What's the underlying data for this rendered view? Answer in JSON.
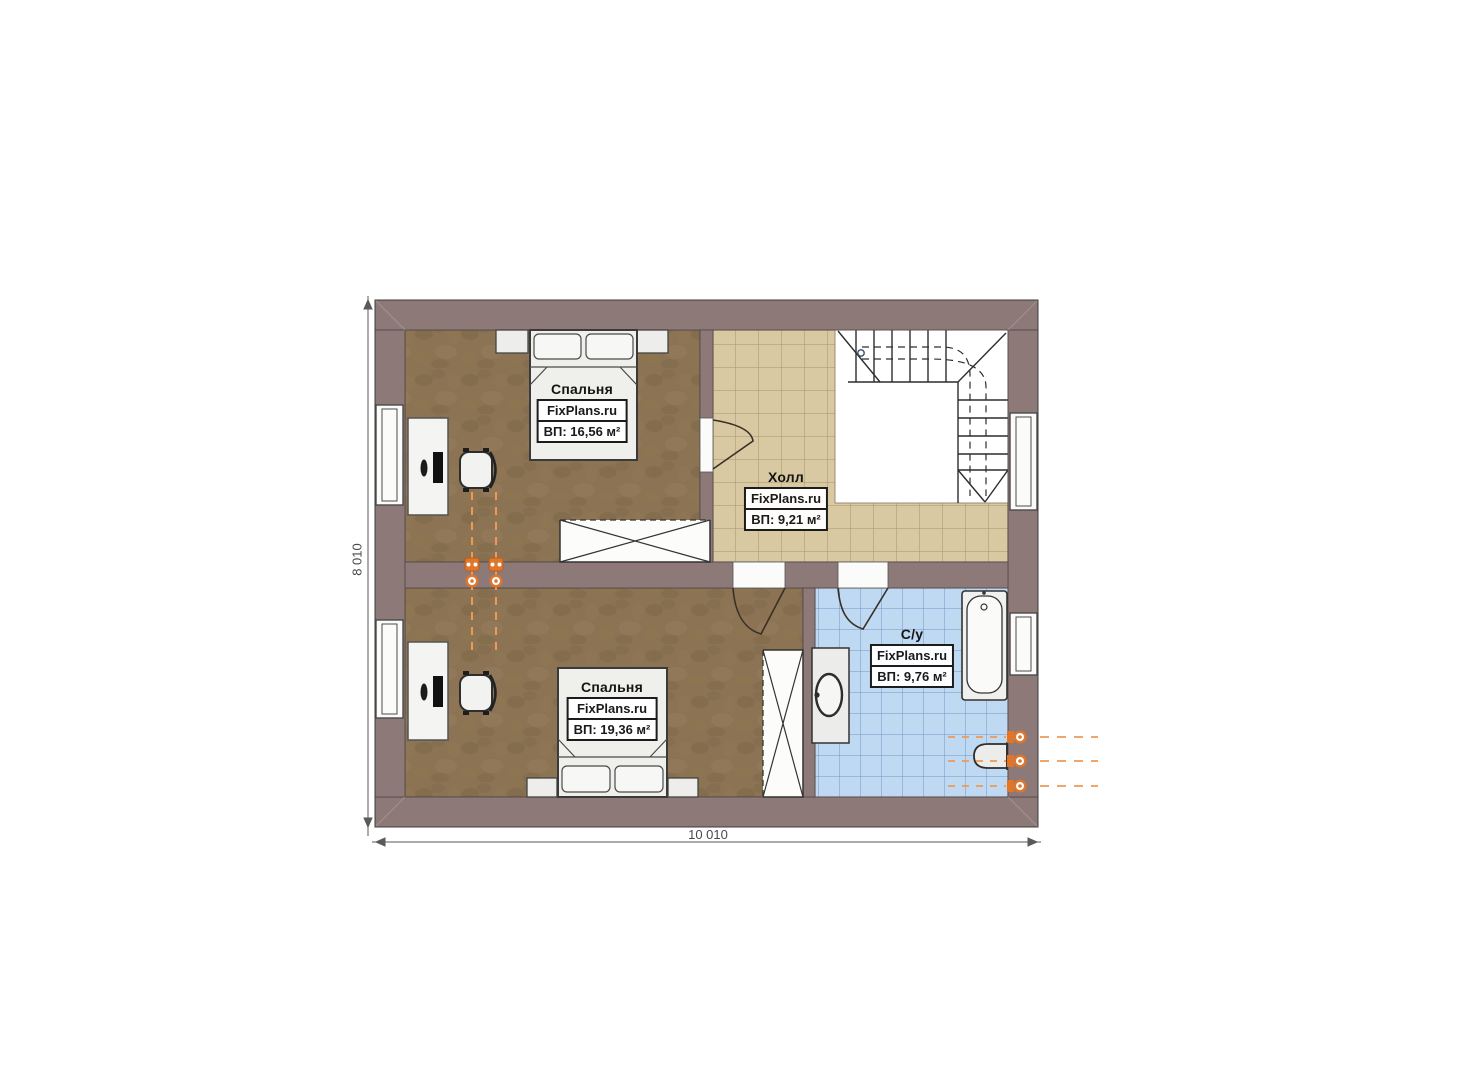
{
  "floorplan": {
    "dimension_width": "10 010",
    "dimension_height": "8 010",
    "rooms": [
      {
        "name": "Спальня",
        "site": "FixPlans.ru",
        "area": "ВП: 16,56 м²"
      },
      {
        "name": "Холл",
        "site": "FixPlans.ru",
        "area": "ВП: 9,21 м²"
      },
      {
        "name": "Спальня",
        "site": "FixPlans.ru",
        "area": "ВП: 19,36 м²"
      },
      {
        "name": "С/у",
        "site": "FixPlans.ru",
        "area": "ВП: 9,76 м²"
      }
    ],
    "colors": {
      "wall": "#8e7979",
      "bedroom_floor": "#8b7353",
      "hall_floor": "#d9c9a2",
      "bathroom_floor": "#bed9f1",
      "plumbing_accent": "#e0762a"
    }
  }
}
